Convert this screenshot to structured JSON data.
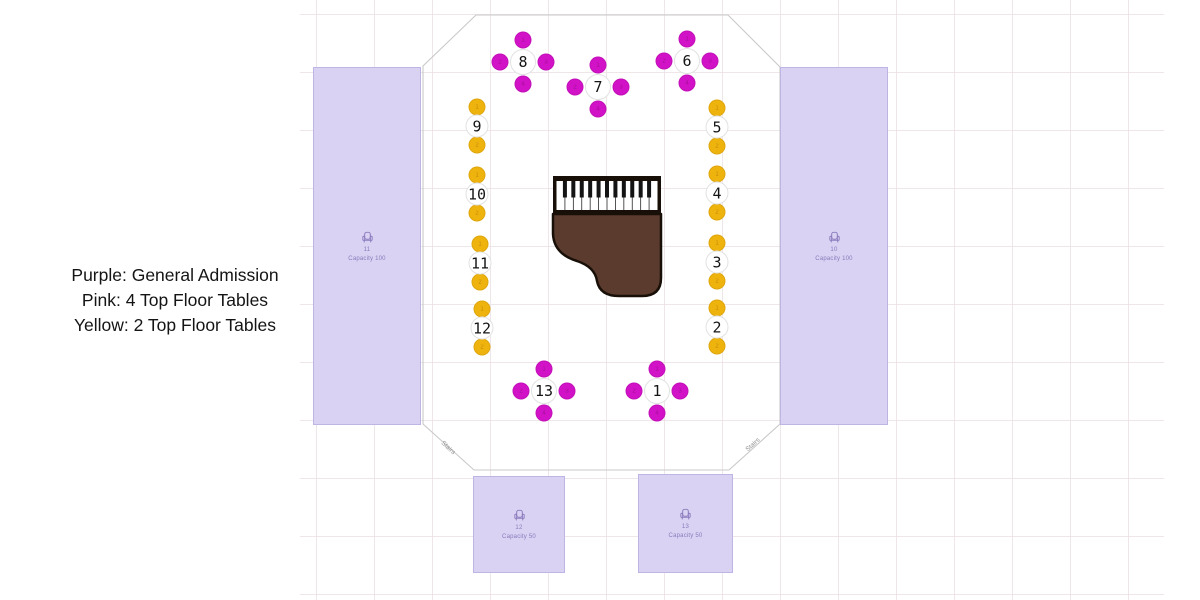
{
  "legend": {
    "lines": [
      "Purple: General Admission",
      "Pink: 4 Top Floor Tables",
      "Yellow: 2 Top Floor Tables"
    ]
  },
  "colors": {
    "ga_fill": "#d9d2f2",
    "ga_label": "#8a7bbd",
    "pink": "#d112c6",
    "pink_seat_num": "#8e0b85",
    "yellow": "#efb30e",
    "yellow_seat_num": "#a3720a",
    "table_fill": "#ffffff",
    "table_border": "#e2e2e2",
    "room_outline": "#c9c9c9",
    "piano_body": "#5b3b2e",
    "piano_frame": "#181008",
    "stairs_text": "#8f8f8f"
  },
  "sections": [
    {
      "id": "left",
      "label": "11",
      "capacity": "Capacity 100"
    },
    {
      "id": "right",
      "label": "10",
      "capacity": "Capacity 100"
    },
    {
      "id": "bottom_left",
      "label": "12",
      "capacity": "Capacity 50"
    },
    {
      "id": "bottom_right",
      "label": "13",
      "capacity": "Capacity 50"
    }
  ],
  "stairs": {
    "left": "Stairs",
    "right": "Stairs"
  },
  "seat_map": {
    "tables": [
      {
        "number": "1",
        "type": "4top",
        "cx": 657,
        "cy": 391
      },
      {
        "number": "2",
        "type": "2top",
        "cx": 717,
        "cy": 327
      },
      {
        "number": "3",
        "type": "2top",
        "cx": 717,
        "cy": 262
      },
      {
        "number": "4",
        "type": "2top",
        "cx": 717,
        "cy": 193
      },
      {
        "number": "5",
        "type": "2top",
        "cx": 717,
        "cy": 127
      },
      {
        "number": "6",
        "type": "4top",
        "cx": 687,
        "cy": 61
      },
      {
        "number": "7",
        "type": "4top",
        "cx": 598,
        "cy": 87
      },
      {
        "number": "8",
        "type": "4top",
        "cx": 523,
        "cy": 62
      },
      {
        "number": "9",
        "type": "2top",
        "cx": 477,
        "cy": 126
      },
      {
        "number": "10",
        "type": "2top",
        "cx": 477,
        "cy": 194
      },
      {
        "number": "11",
        "type": "2top",
        "cx": 480,
        "cy": 263
      },
      {
        "number": "12",
        "type": "2top",
        "cx": 482,
        "cy": 328
      },
      {
        "number": "13",
        "type": "4top",
        "cx": 544,
        "cy": 391
      }
    ],
    "seats_per_type": {
      "4top": [
        "1",
        "2",
        "3",
        "4"
      ],
      "2top": [
        "1",
        "2"
      ]
    }
  }
}
